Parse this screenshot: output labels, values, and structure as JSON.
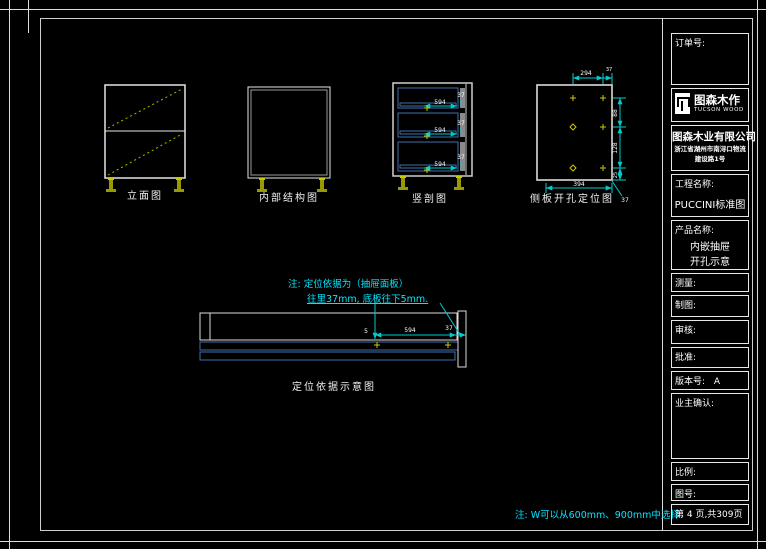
{
  "colors": {
    "frame_white": "#dcdcdc",
    "dim_cyan": "#00cccc",
    "note_cyan": "#00e5ff",
    "hardware_yellow": "#b5b500",
    "drawer_blue": "#3f6fae"
  },
  "views": {
    "elevation": {
      "caption": "立面图"
    },
    "internal": {
      "caption": "内部结构图"
    },
    "section": {
      "caption": "竖剖图",
      "depth": "594",
      "inset": "37"
    },
    "side_panel": {
      "caption": "侧板开孔定位图",
      "top_span": "294",
      "top_inset": "37",
      "right_top": "88",
      "right_mid": "128",
      "right_bottom": "25",
      "bottom_span": "394",
      "leader": "37"
    },
    "basis": {
      "caption": "定位依据示意图",
      "depth": "594",
      "inset": "37",
      "down": "5"
    }
  },
  "notes": {
    "pos_line1": "注: 定位依据为（抽屉面板）",
    "pos_line2": "往里37mm, 底板往下5mm.",
    "width_note": "注: W可以从600mm、900mm中选择."
  },
  "title_block": {
    "order_label": "订单号:",
    "brand": "图森木作",
    "brand_en": "TUCSON WOOD",
    "company": "图森木业有限公司",
    "address1": "浙江省湖州市南浔口物流",
    "address2": "建设路1号",
    "project_label": "工程名称:",
    "project_value": "PUCCINI标准图",
    "product_label": "产品名称:",
    "product_line1": "内嵌抽屉",
    "product_line2": "开孔示意",
    "measure_label": "测量:",
    "draft_label": "制图:",
    "audit_label": "审核:",
    "approve_label": "批准:",
    "version_label": "版本号:",
    "version_value": "A",
    "owner_label": "业主确认:",
    "scale_label": "比例:",
    "figure_label": "图号:",
    "page_info": "第 4 页,共309页"
  }
}
